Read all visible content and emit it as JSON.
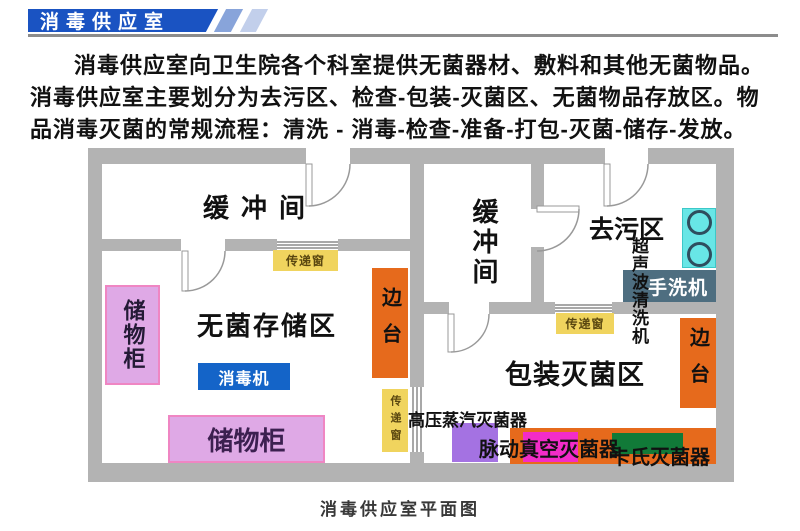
{
  "header": {
    "banner_title": "消毒供应室"
  },
  "intro": {
    "text": "消毒供应室向卫生院各个科室提供无菌器材、敷料和其他无菌物品。消毒供应室主要划分为去污区、检查-包装-灭菌区、无菌物品存放区。物品消毒灭菌的常规流程：清洗 - 消毒-检查-准备-打包-灭菌-储存-发放。"
  },
  "floor_plan": {
    "rooms": {
      "buffer_left": "缓冲间",
      "buffer_right": "缓冲间",
      "decontamination": "去污区",
      "sterile_storage": "无菌存储区",
      "packaging_sterilization": "包装灭菌区"
    },
    "equipment": {
      "storage_cabinet": "储物柜",
      "disinfector": "消毒机",
      "side_table": "边台",
      "ultrasonic_cleaner": "超声波清洗机",
      "hand_washer": "手洗机",
      "autoclave": "高压蒸汽灭菌器",
      "pulse_vacuum_sterilizer": "脉动真空灭菌器",
      "cassette_sterilizer": "卡氏灭菌器"
    },
    "transfer_window_label": "传递窗"
  },
  "caption": "消毒供应室平面图",
  "colors": {
    "banner_blue": "#1a53c2",
    "wall_gray": "#b3b3b3",
    "transfer_window_yellow": "#f0d45e",
    "cabinet_violet": "#dfa9e6",
    "cabinet_border_pink": "#ef86c3",
    "disinfector_blue": "#1464c8",
    "side_table_orange": "#e66a1c",
    "ultrasonic_cyan": "#68e6e6",
    "hand_washer_slate": "#4e6e80",
    "autoclave_purple": "#a472e2",
    "pulse_vacuum_magenta": "#f32cc8",
    "cassette_green": "#117a38"
  }
}
